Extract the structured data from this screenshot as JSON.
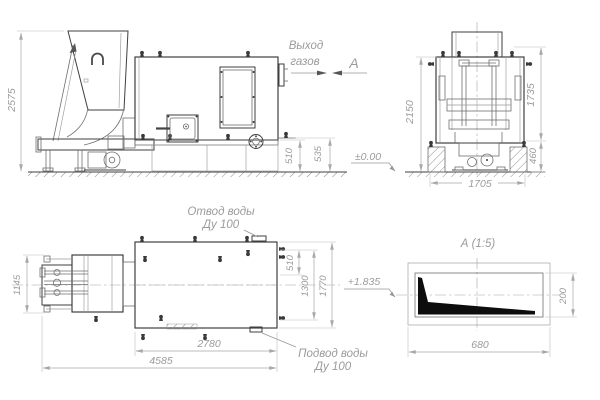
{
  "colors": {
    "line": "#3f3f3f",
    "line_medium": "#6f6f6f",
    "line_light": "#9a9a9a",
    "dimension": "#a8a8a8",
    "text": "#9b9b9b",
    "section_fill": "#0d0d0d",
    "background": "#ffffff"
  },
  "labels": {
    "gas_outlet": {
      "line1": "Выход",
      "line2": "газов"
    },
    "section_arrow": "А",
    "section_title": "А  (1:5)",
    "water_outlet": {
      "line1": "Отвод воды",
      "line2": "Ду 100"
    },
    "water_inlet": {
      "line1": "Подвод воды",
      "line2": "Ду 100"
    }
  },
  "levels": {
    "ground": "±0.00",
    "axis": "+1.835"
  },
  "side_view": {
    "dims": {
      "height": "2575",
      "base_front": "510",
      "base_rear": "535"
    }
  },
  "front_view": {
    "dims": {
      "height_total": "2150",
      "height_body": "1735",
      "height_base": "460",
      "width": "1705"
    }
  },
  "plan_view": {
    "dims": {
      "feeder_width": "1145",
      "length_total": "4585",
      "length_body": "2780",
      "nozzle_offset": "510",
      "nozzle_span": "1300",
      "body_width": "1770"
    }
  },
  "section_view": {
    "dims": {
      "width": "680",
      "height": "200"
    }
  }
}
